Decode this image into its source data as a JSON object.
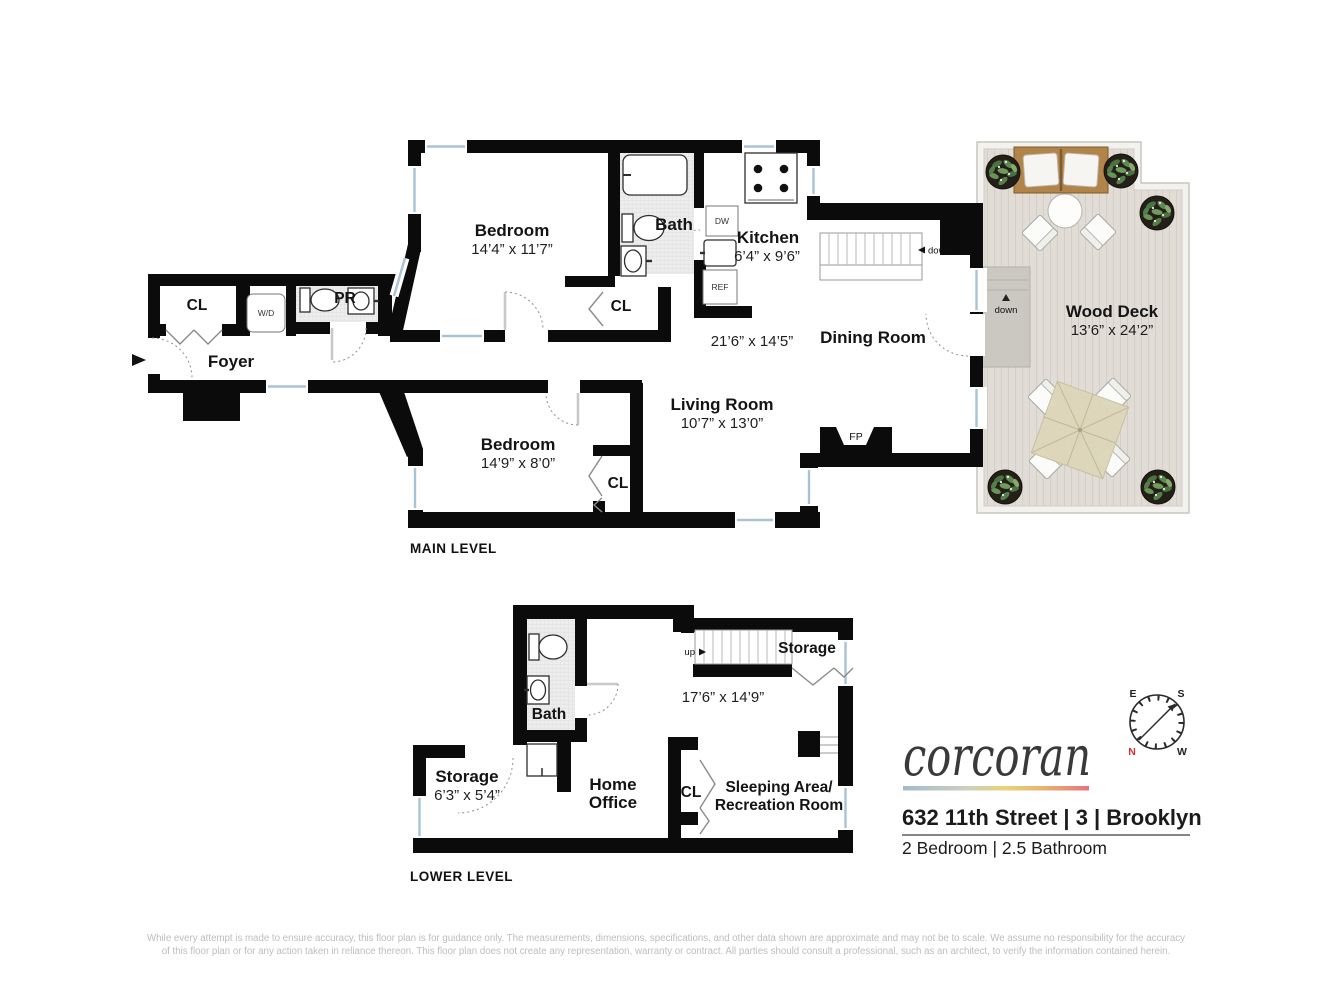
{
  "main_level": {
    "label": "MAIN LEVEL",
    "bedroom_top": {
      "name": "Bedroom",
      "dims": "14’4” x 11’7”"
    },
    "bedroom_bottom": {
      "name": "Bedroom",
      "dims": "14’9” x 8’0”"
    },
    "bath": "Bath",
    "kitchen": {
      "name": "Kitchen",
      "dims": "6’4” x 9’6”"
    },
    "dining_room": "Dining Room",
    "living_room": {
      "name": "Living Room",
      "dims": "10’7” x 13’0”"
    },
    "open_area_dims": "21’6” x 14’5”",
    "foyer": "Foyer",
    "wood_deck": {
      "name": "Wood Deck",
      "dims": "13’6” x 24’2”"
    },
    "closet": "CL",
    "powder_room": "PR",
    "washer_dryer": "W/D",
    "dishwasher": "DW",
    "refrigerator": "REF",
    "fireplace": "FP",
    "stairs_down": "down"
  },
  "lower_level": {
    "label": "LOWER LEVEL",
    "bath": "Bath",
    "storage": {
      "name": "Storage",
      "dims": "6’3” x 5’4”"
    },
    "home_office": {
      "line1": "Home",
      "line2": "Office"
    },
    "closet": "CL",
    "sleeping_area": {
      "line1": "Sleeping Area/",
      "line2": "Recreation Room"
    },
    "storage_upper": "Storage",
    "area_dims": "17’6” x 14’9”",
    "stairs_up": "up"
  },
  "branding": {
    "logo": "corcoran",
    "address": "632 11th Street | 3 | Brooklyn",
    "summary": "2 Bedroom | 2.5 Bathroom"
  },
  "compass": {
    "north": "N",
    "south": "S",
    "east": "E",
    "west": "W"
  },
  "colors": {
    "walls": "#0b0b0b",
    "window_glass": "#a9c3d6",
    "compass_north": "#cc3333",
    "deck_floor": "#e1ddd6",
    "brand_gradient": [
      "#a3bccb",
      "#e8d27a",
      "#e5737d"
    ]
  },
  "disclaimer": {
    "line1": "While every attempt is made to ensure accuracy, this floor plan is for guidance only. The measurements, dimensions, specifications, and other data shown are approximate and may not be to scale. We assume no responsibility for the accuracy",
    "line2": "of this floor plan or for any action taken in reliance thereon. This floor plan does not create any representation, warranty or contract. All parties should consult a professional, such as an architect, to verify the information contained herein."
  }
}
